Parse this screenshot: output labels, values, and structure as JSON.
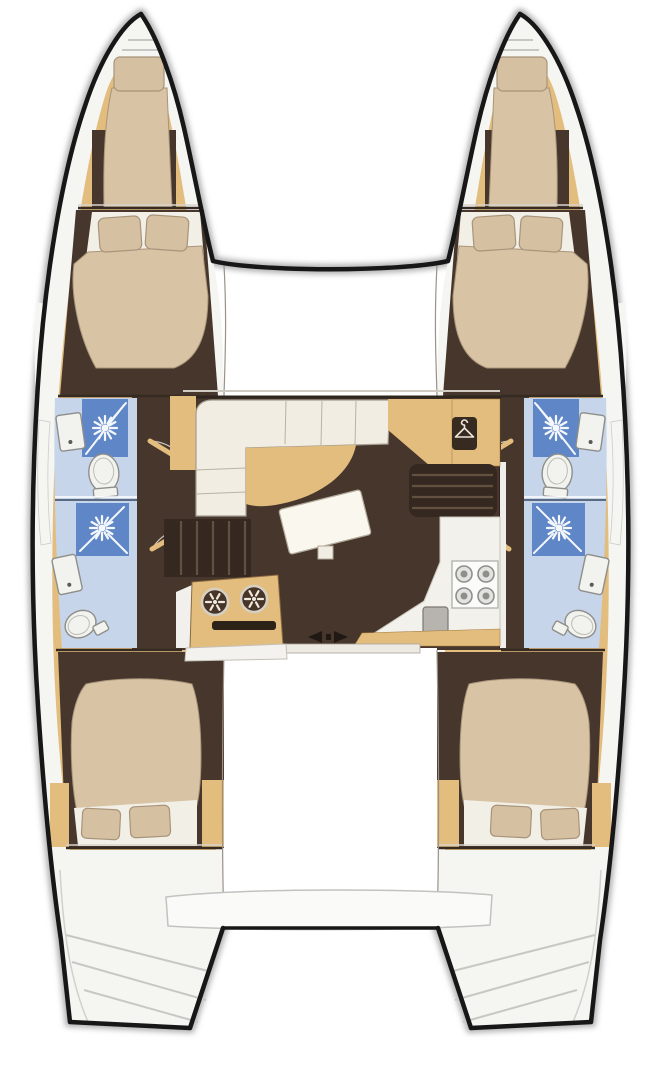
{
  "page": {
    "title": "Catamaran 4-cabin layout floor plan",
    "kind": "boat-floor-plan",
    "orientation": "bow-up"
  },
  "colors": {
    "outline": "#171717",
    "shadow": "#9c9c9c",
    "deck": "#f5f5f2",
    "deck_line": "#c7c7c3",
    "wood": "#e3bd7d",
    "wood_dark": "#a87f46",
    "floor": "#46362b",
    "floor_dark": "#342820",
    "bulkhead": "#352b22",
    "bed": "#d8c3a4",
    "pillow": "#d5c0a2",
    "pillow_edge": "#a8947a",
    "sheet": "#f2efe7",
    "sofa": "#f1ede2",
    "sofa_seam": "#b9b2a4",
    "table": "#faf7ef",
    "bath_bg": "#c6d5ea",
    "shower": "#5f86c6",
    "fixture_white": "#f2f2ee",
    "fixture_line": "#8e8e8a",
    "stove_ring": "#8e8e8a",
    "sink_gray": "#b7b4b0",
    "dial_face": "#473528",
    "icon_light": "#efeae0",
    "platform": "#fafaf8",
    "track": "#eceae3",
    "arrow": "#201913",
    "wardrobe": "#372a21"
  },
  "features": {
    "hulls": [
      "port-hull",
      "starboard-hull"
    ],
    "port_hull": [
      "forepeak-berth",
      "forward-double-cabin",
      "forward-head-shower",
      "aft-head-shower",
      "aft-double-cabin",
      "stern-steps"
    ],
    "starboard_hull": [
      "forepeak-berth",
      "forward-double-cabin",
      "forward-head-shower",
      "aft-head-shower",
      "aft-double-cabin",
      "stern-steps"
    ],
    "salon": [
      "l-shaped-sofa",
      "dining-table",
      "wardrobe",
      "instrument-panel-dials",
      "galley-stove",
      "galley-sink",
      "port-companionway-stairs",
      "starboard-companionway-stairs",
      "sliding-door"
    ],
    "exterior": [
      "bow-trampoline-area",
      "forward-crossbeam",
      "aft-platform"
    ]
  },
  "icons": {
    "shower": "starburst-showerhead",
    "wardrobe": "clothes-hanger",
    "stove": "four-burner-hob",
    "instrument": "spoked-dial",
    "sliding_door": "left-right-arrows"
  }
}
